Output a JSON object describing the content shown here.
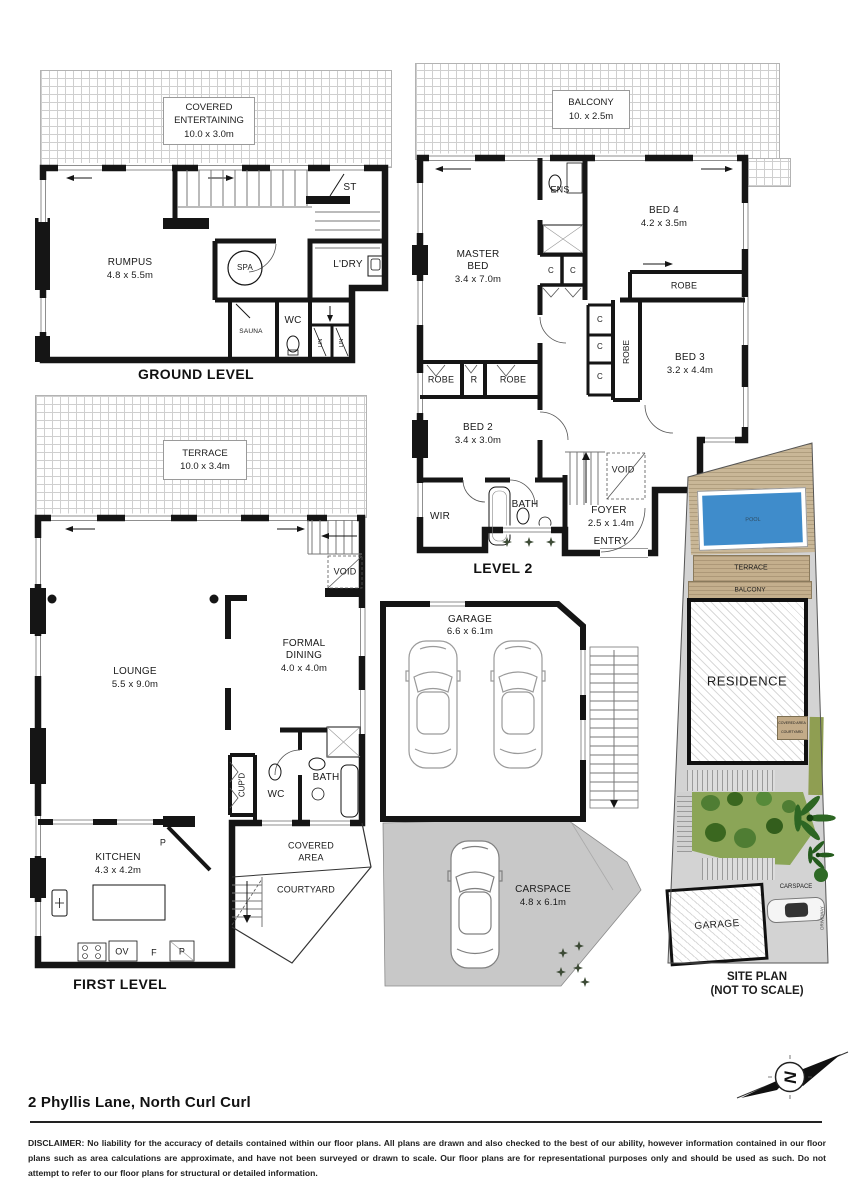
{
  "page": {
    "address": "2 Phyllis Lane, North Curl Curl",
    "compass_letter": "N",
    "disclaimer_lead": "DISCLAIMER:",
    "disclaimer_body": " No liability for the accuracy of details contained within our floor plans. All plans are drawn and also checked to the best of our ability, however information contained in our floor plans such as area calculations are approximate, and have not been surveyed or drawn to scale. Our floor plans are for representational purposes only and should be used as such. Do not attempt to refer to our floor plans for structural or detailed information."
  },
  "ground": {
    "title": "GROUND LEVEL",
    "covered_entertaining_l1": "COVERED",
    "covered_entertaining_l2": "ENTERTAINING",
    "covered_entertaining_dims": "10.0 x 3.0m",
    "rumpus": "RUMPUS",
    "rumpus_dims": "4.8 x 5.5m",
    "spa": "SPA",
    "st": "ST",
    "ldry": "L'DRY",
    "sauna": "SAUNA",
    "wc": "WC",
    "lin": "LIN"
  },
  "level2": {
    "title": "LEVEL 2",
    "balcony": "BALCONY",
    "balcony_dims": "10. x 2.5m",
    "master_l1": "MASTER",
    "master_l2": "BED",
    "master_dims": "3.4 x 7.0m",
    "ens": "ENS",
    "bed4": "BED 4",
    "bed4_dims": "4.2 x 3.5m",
    "bed3": "BED 3",
    "bed3_dims": "3.2 x 4.4m",
    "bed2": "BED 2",
    "bed2_dims": "3.4 x 3.0m",
    "robe": "ROBE",
    "r": "R",
    "c": "C",
    "wir": "WIR",
    "bath": "BATH",
    "void": "VOID",
    "foyer": "FOYER",
    "foyer_dims": "2.5 x 1.4m",
    "entry": "ENTRY"
  },
  "first": {
    "title": "FIRST LEVEL",
    "terrace": "TERRACE",
    "terrace_dims": "10.0 x 3.4m",
    "lounge": "LOUNGE",
    "lounge_dims": "5.5 x 9.0m",
    "dining_l1": "FORMAL",
    "dining_l2": "DINING",
    "dining_dims": "4.0 x 4.0m",
    "void": "VOID",
    "cupd": "CUP'D",
    "wc": "WC",
    "bath": "BATH",
    "covered_l1": "COVERED",
    "covered_l2": "AREA",
    "courtyard": "COURTYARD",
    "kitchen": "KITCHEN",
    "kitchen_dims": "4.3 x 4.2m",
    "p": "P",
    "ov": "OV",
    "f": "F"
  },
  "garage_plan": {
    "name": "GARAGE",
    "dims": "6.6 x 6.1m"
  },
  "carspace_plan": {
    "name": "CARSPACE",
    "dims": "4.8 x 6.1m"
  },
  "site": {
    "title_l1": "SITE PLAN",
    "title_l2": "(NOT TO SCALE)",
    "pool": "POOL",
    "terrace": "TERRACE",
    "balcony": "BALCONY",
    "residence": "RESIDENCE",
    "covered_area": "COVERED AREA",
    "courtyard": "COURTYARD",
    "garage": "GARAGE",
    "carspace": "CARSPACE",
    "driveway": "DRIVEWAY"
  },
  "colors": {
    "wall": "#151515",
    "deck_tan": "#c9b797",
    "strip_tan": "#c4af8d",
    "pool_blue": "#3f8ccb",
    "garden_green": "#8ba557",
    "shrub_dark": "#3a671f",
    "shrub_mid": "#4f7d33",
    "palm_green": "#2d6623",
    "olive": "#8f9e52",
    "path_gray": "#d6d6d6",
    "carspace_gray": "#c8c8c8"
  }
}
